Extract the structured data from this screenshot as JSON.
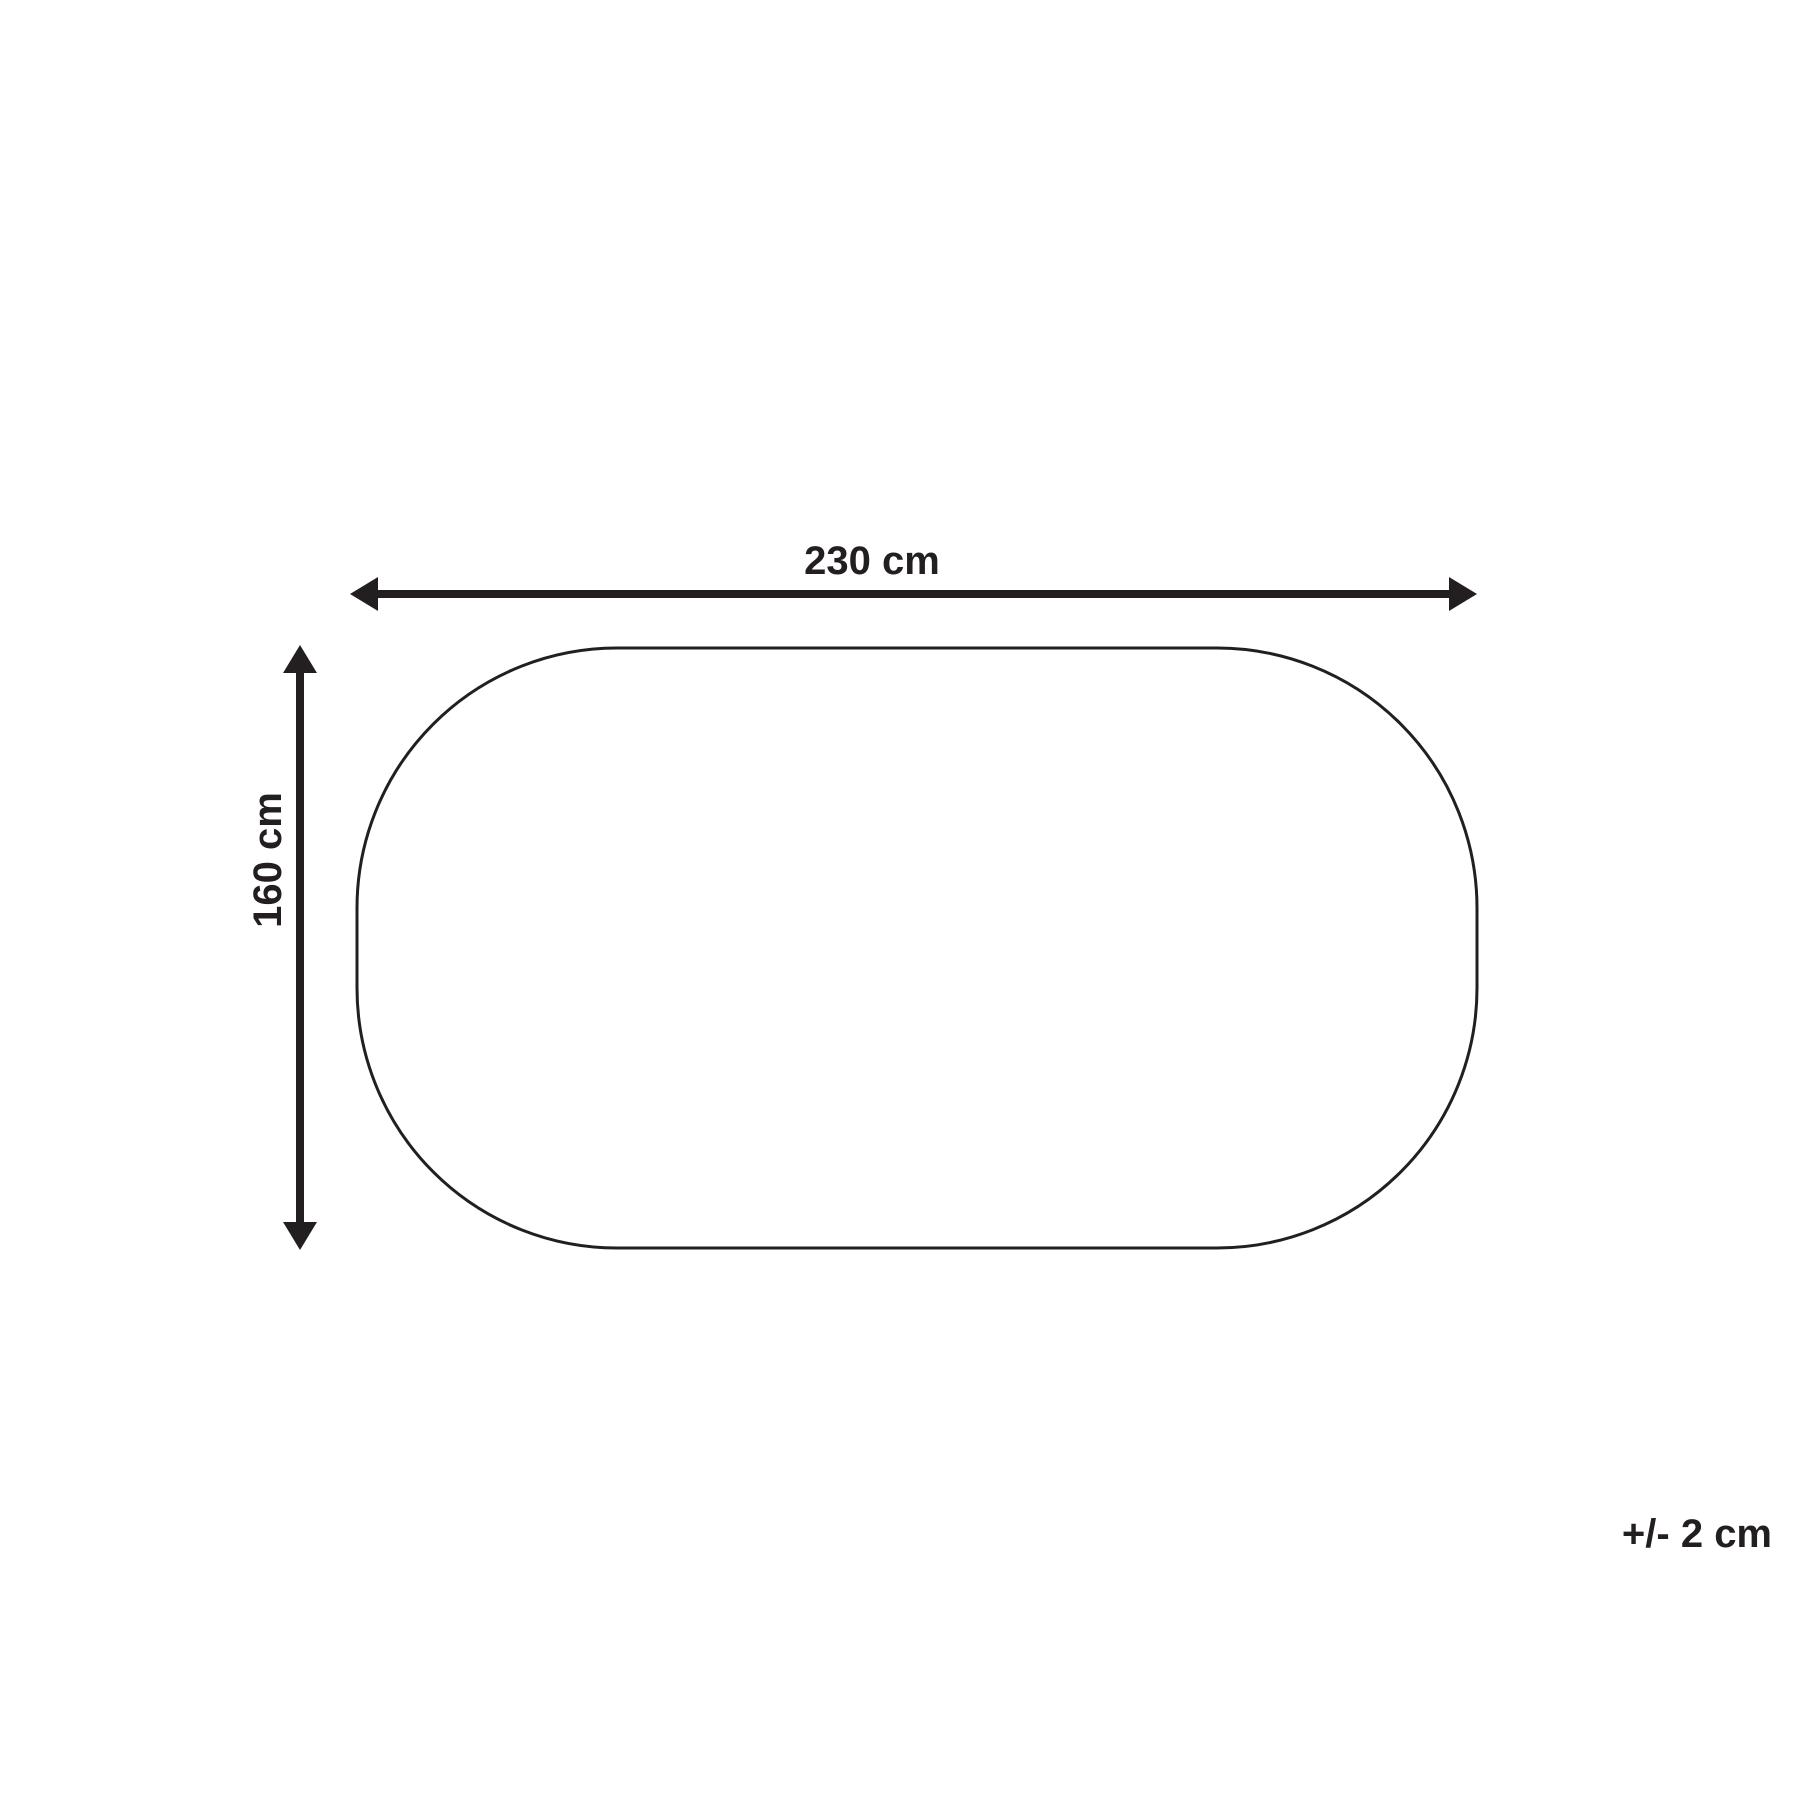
{
  "page": {
    "background": "#ffffff"
  },
  "colors": {
    "line": "#231f20",
    "text": "#231f20"
  },
  "diagram": {
    "type": "product-dimension-diagram",
    "shape": "stadium-oval-outline",
    "width_label": "230 cm",
    "height_label": "160 cm",
    "tolerance_label": "+/- 2 cm"
  }
}
